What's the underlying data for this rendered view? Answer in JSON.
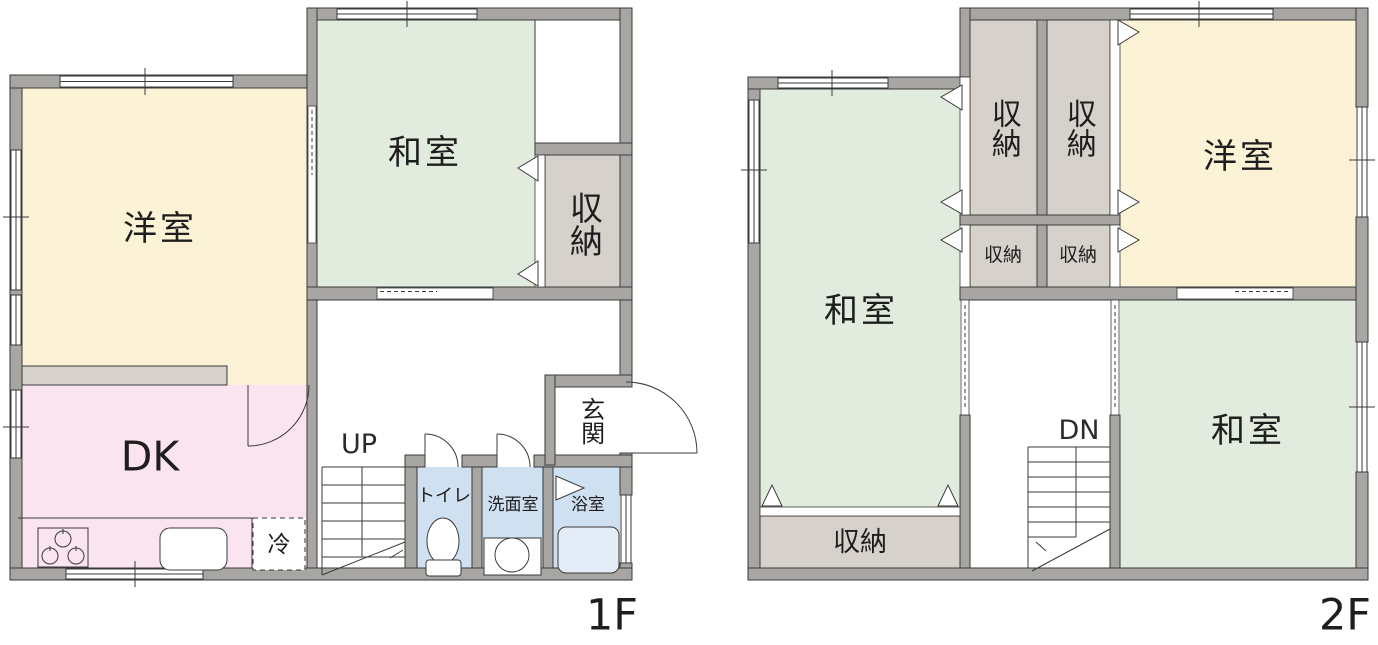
{
  "title": "2-story house floor plan",
  "colors": {
    "wall": "#a8a6a3",
    "outline": "#3a3a3a",
    "western_room": "#fcf3d6",
    "japanese_room": "#e1ecdf",
    "closet": "#d7d1cc",
    "dining_kitchen": "#fae4ef",
    "sanitary": "#cfe0f0",
    "bathtub": "#e4edf7",
    "text": "#1e1e1e"
  },
  "floor1": {
    "floor_label": "1F",
    "western_room": "洋室",
    "japanese_room": "和室",
    "closet": "収納",
    "dining_kitchen": "DK",
    "fridge": "冷",
    "stairs_up": "UP",
    "toilet": "トイレ",
    "washroom": "洗面室",
    "bathroom": "浴室",
    "entrance": "玄関"
  },
  "floor2": {
    "floor_label": "2F",
    "japanese_room_left": "和室",
    "japanese_room_right": "和室",
    "western_room": "洋室",
    "closet_tall_left": "収納",
    "closet_tall_right": "収納",
    "closet_small_left": "収納",
    "closet_small_right": "収納",
    "closet_bottom": "収納",
    "stairs_down": "DN"
  }
}
